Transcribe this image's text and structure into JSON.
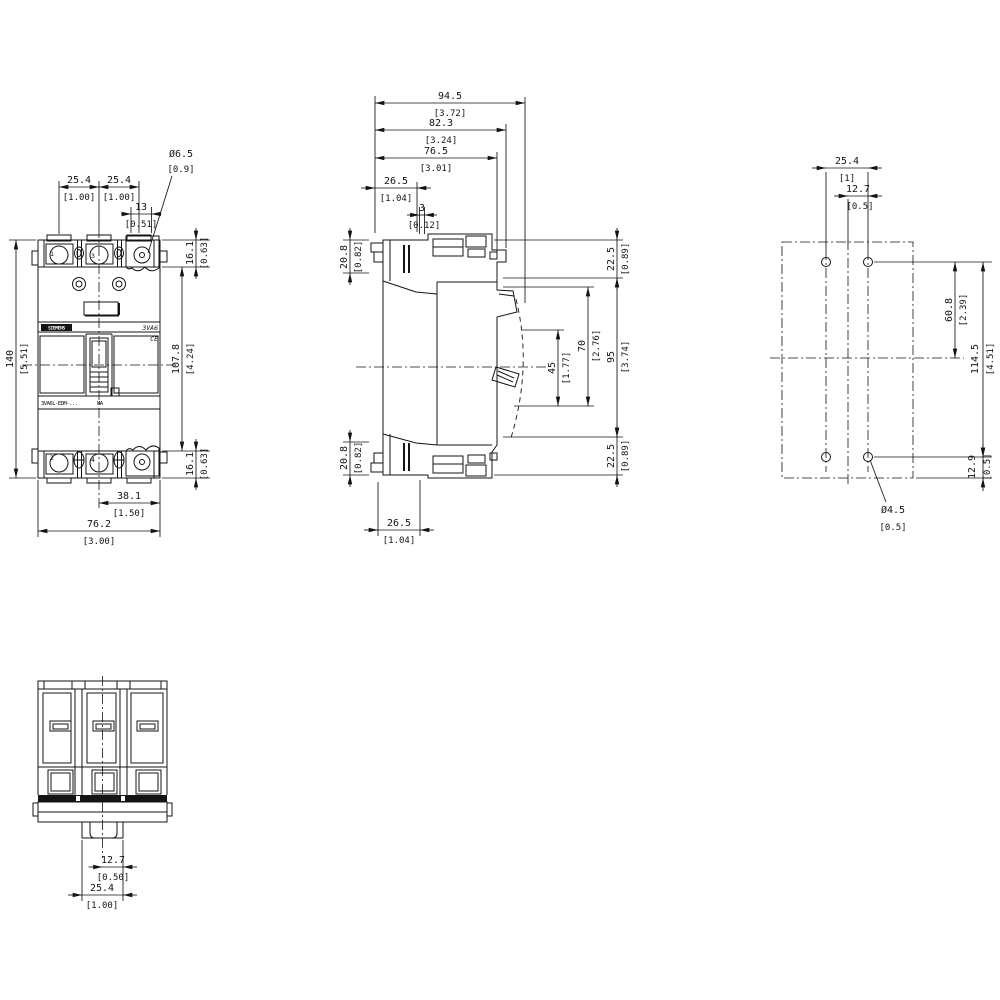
{
  "colors": {
    "background": "#ffffff",
    "line": "#141414"
  },
  "drawing": {
    "front": {
      "pitch1": {
        "mm": "25.4",
        "in": "[1.00]"
      },
      "pitch2": {
        "mm": "25.4",
        "in": "[1.00]"
      },
      "slot13": {
        "mm": "13",
        "in": "[0.51]"
      },
      "hole": {
        "mm": "Ø6.5",
        "in": "[0.9]"
      },
      "height": {
        "mm": "140",
        "in": "[5.51]"
      },
      "term_top": {
        "mm": "16.1",
        "in": "[0.63]"
      },
      "body": {
        "mm": "107.8",
        "in": "[4.24]"
      },
      "term_bot": {
        "mm": "16.1",
        "in": "[0.63]"
      },
      "half_width": {
        "mm": "38.1",
        "in": "[1.50]"
      },
      "width": {
        "mm": "76.2",
        "in": "[3.00]"
      },
      "labels": {
        "brand": "SIEMENS",
        "series": "3VA6",
        "ce": "CE",
        "model": "3VA6L-EDM-...",
        "rating": "MA",
        "pole1": "1",
        "pole3": "3",
        "pole2": "2",
        "pole4": "4"
      }
    },
    "side": {
      "depth_total": {
        "mm": "94.5",
        "in": "[3.72]"
      },
      "depth_mid": {
        "mm": "82.3",
        "in": "[3.24]"
      },
      "depth_front": {
        "mm": "76.5",
        "in": "[3.01]"
      },
      "front_top": {
        "mm": "26.5",
        "in": "[1.04]"
      },
      "offset3": {
        "mm": "3",
        "in": "[0.12]"
      },
      "rail_top": {
        "mm": "20.8",
        "in": "[0.82]"
      },
      "rail_bot": {
        "mm": "20.8",
        "in": "[0.82]"
      },
      "term_top": {
        "mm": "22.5",
        "in": "[0.89]"
      },
      "handle_on": {
        "mm": "45",
        "in": "[1.77]"
      },
      "handle_off": {
        "mm": "70",
        "in": "[2.76]"
      },
      "body_h": {
        "mm": "95",
        "in": "[3.74]"
      },
      "term_bot": {
        "mm": "22.5",
        "in": "[0.89]"
      },
      "front_bot": {
        "mm": "26.5",
        "in": "[1.04]"
      }
    },
    "plate": {
      "hole_pitch": {
        "mm": "25.4",
        "in": "[1]"
      },
      "half_pitch": {
        "mm": "12.7",
        "in": "[0.5]"
      },
      "upper_span": {
        "mm": "60.8",
        "in": "[2.39]"
      },
      "vert_span": {
        "mm": "114.5",
        "in": "[4.51]"
      },
      "edge": {
        "mm": "12.9",
        "in": "[0.5]"
      },
      "hole": {
        "mm": "Ø4.5",
        "in": "[0.5]"
      }
    },
    "bottom": {
      "half_tab": {
        "mm": "12.7",
        "in": "[0.50]"
      },
      "tab": {
        "mm": "25.4",
        "in": "[1.00]"
      }
    }
  }
}
